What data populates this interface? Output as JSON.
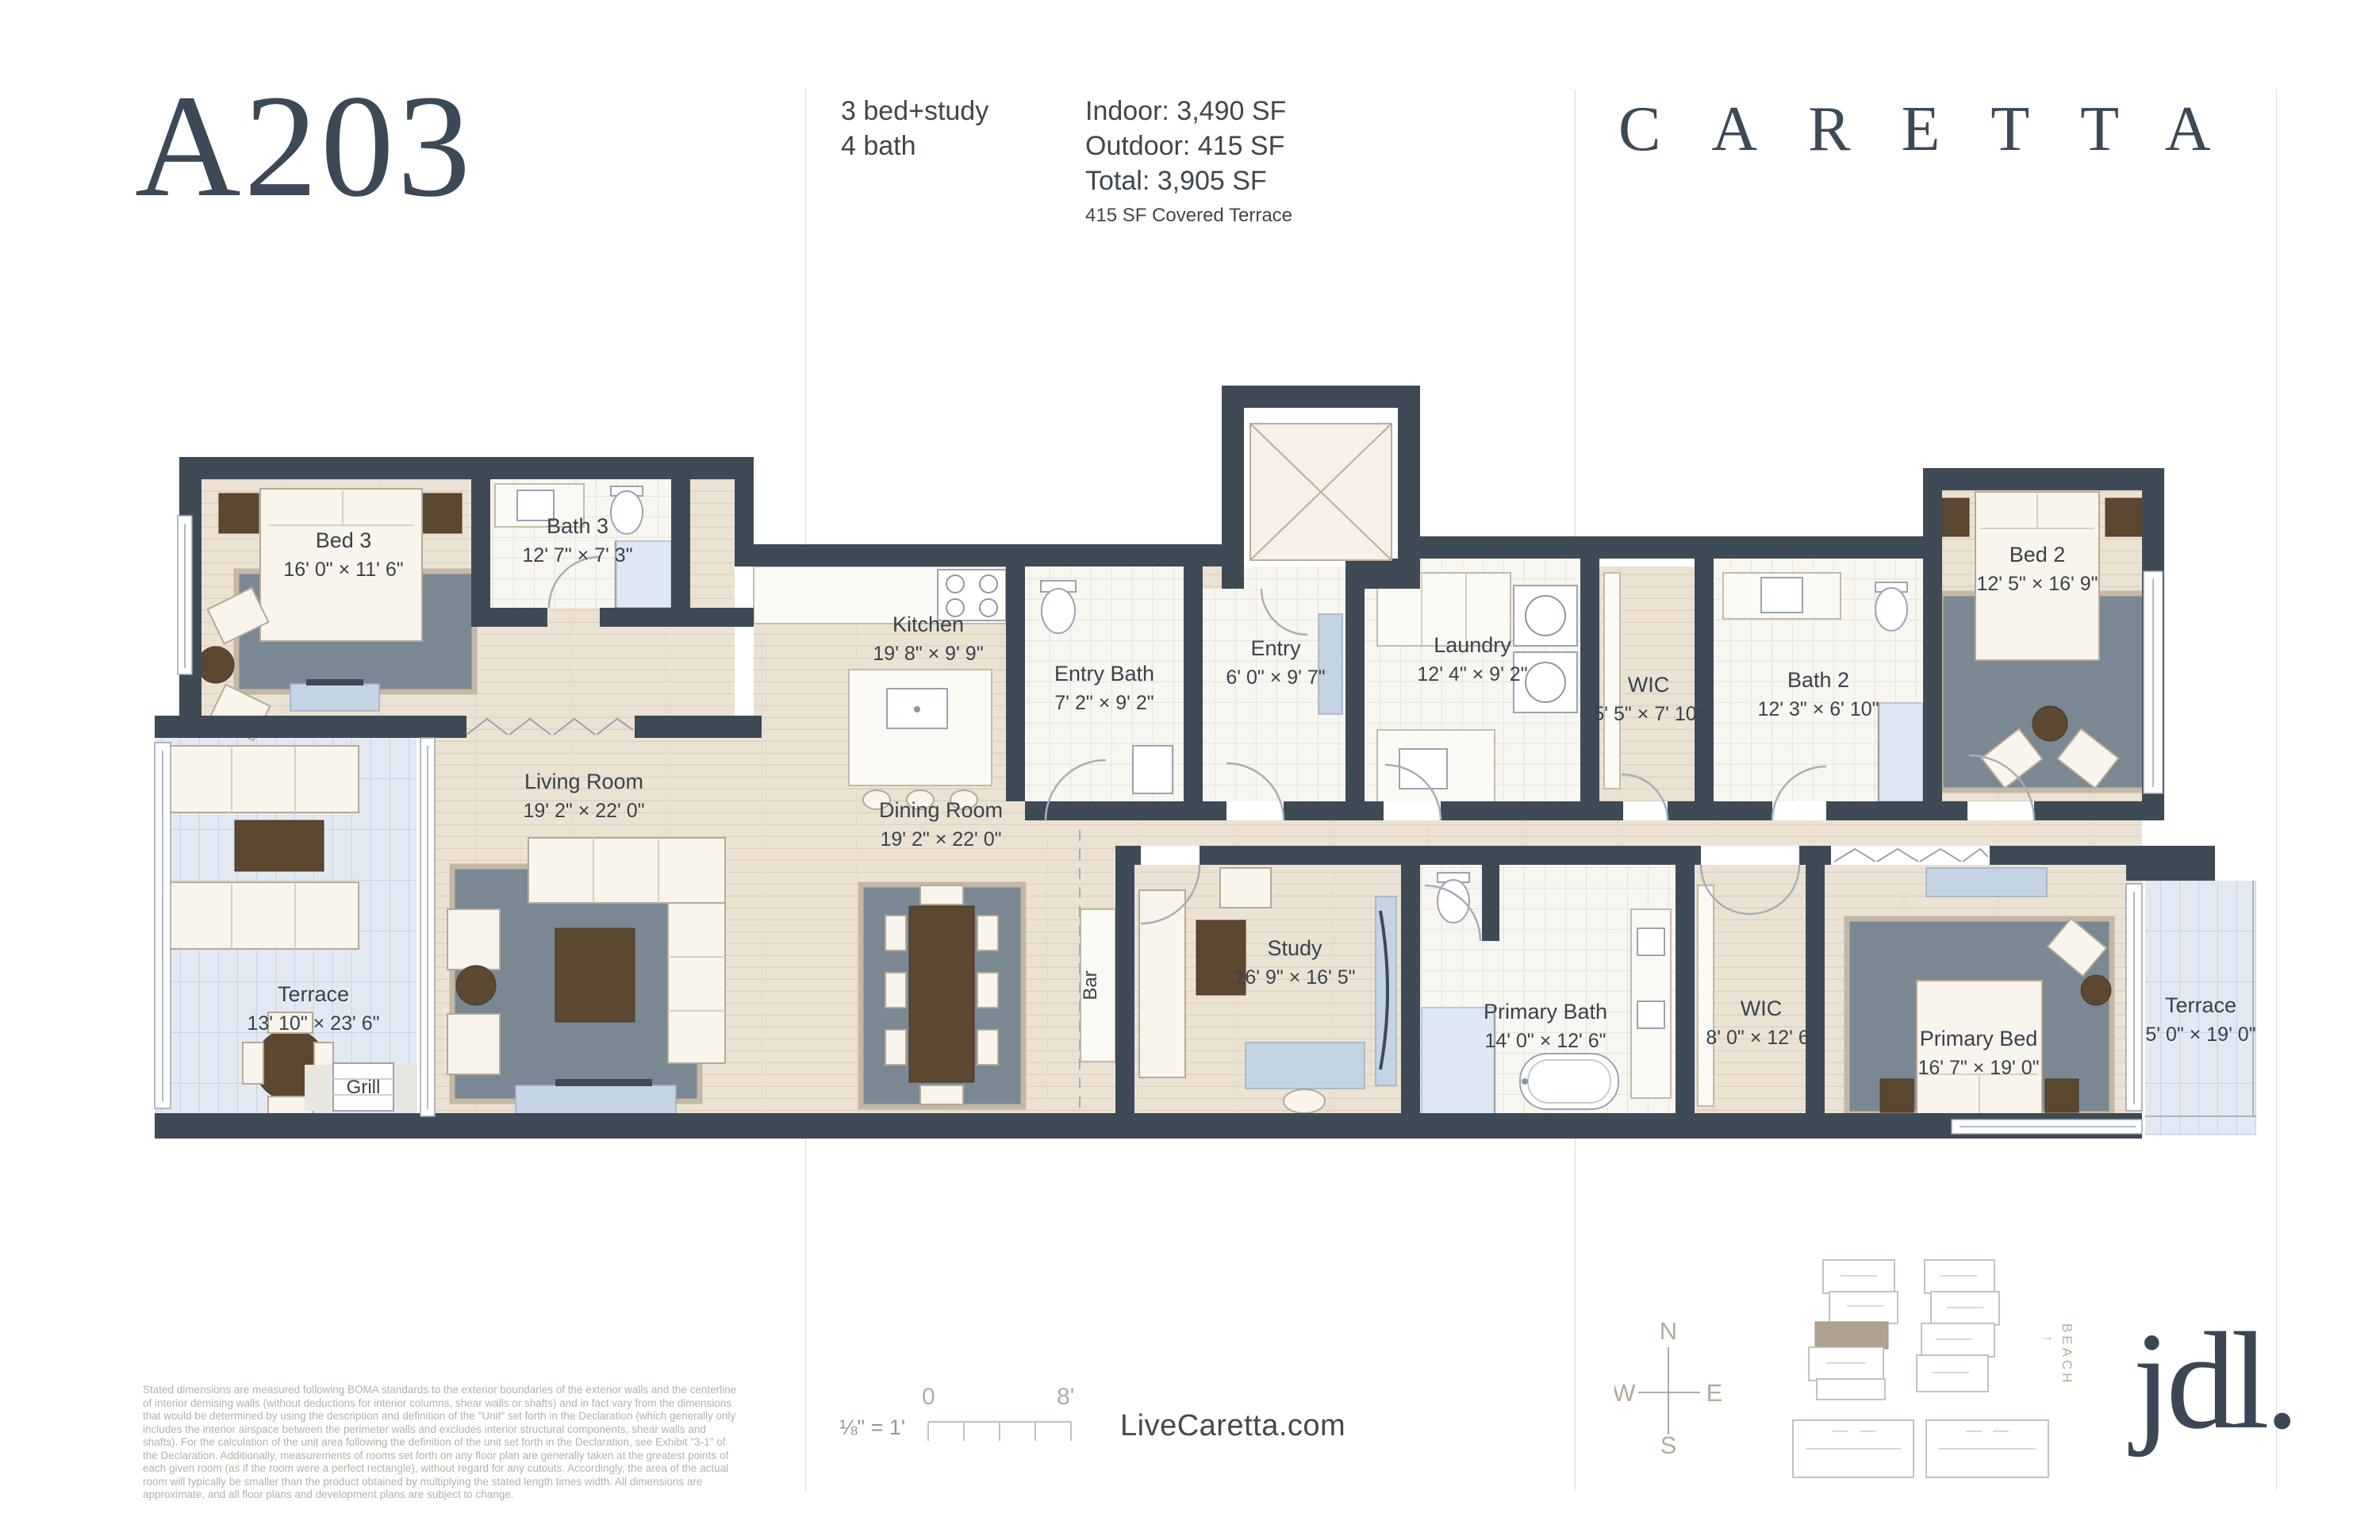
{
  "header": {
    "unit_id": "A203",
    "program": {
      "line1": "3 bed+study",
      "line2": "4 bath"
    },
    "areas": {
      "indoor": "Indoor: 3,490 SF",
      "outdoor": "Outdoor: 415 SF",
      "total": "Total: 3,905 SF",
      "note": "415 SF Covered Terrace"
    },
    "brand": "CARETTA"
  },
  "floorplan": {
    "rooms": [
      {
        "name": "Bed 3",
        "dims": "16' 0\" × 11' 6\""
      },
      {
        "name": "Bath 3",
        "dims": "12' 7\" × 7' 3\""
      },
      {
        "name": "Kitchen",
        "dims": "19' 8\" × 9' 9\""
      },
      {
        "name": "Entry Bath",
        "dims": "7' 2\" × 9' 2\""
      },
      {
        "name": "Entry",
        "dims": "6' 0\" × 9' 7\""
      },
      {
        "name": "Laundry",
        "dims": "12' 4\" × 9' 2\""
      },
      {
        "name": "WIC",
        "dims": "5' 5\" × 7' 10\""
      },
      {
        "name": "Bath 2",
        "dims": "12' 3\" × 6' 10\""
      },
      {
        "name": "Bed 2",
        "dims": "12' 5\" × 16' 9\""
      },
      {
        "name": "Living Room",
        "dims": "19' 2\" × 22' 0\""
      },
      {
        "name": "Dining Room",
        "dims": "19' 2\" × 22' 0\""
      },
      {
        "name": "Terrace",
        "dims": "13' 10\" × 23' 6\""
      },
      {
        "name": "Study",
        "dims": "16' 9\" × 16' 5\""
      },
      {
        "name": "Primary Bath",
        "dims": "14' 0\" × 12' 6\""
      },
      {
        "name": "WIC",
        "dims": "8' 0\" × 12' 6\""
      },
      {
        "name": "Primary Bed",
        "dims": "16' 7\" × 19' 0\""
      },
      {
        "name": "Terrace",
        "dims": "5' 0\" × 19' 0\""
      },
      {
        "name": "Grill",
        "dims": ""
      },
      {
        "name": "Bar",
        "dims": ""
      }
    ]
  },
  "footer": {
    "disclaimer": "Stated dimensions are measured following BOMA standards to the exterior boundaries of the exterior walls and the centerline of interior demising walls (without deductions for interior columns, shear walls or shafts) and in fact vary from the dimensions that would be determined by using the description and definition of the \"Unit\" set forth in the Declaration (which generally only includes the interior airspace between the perimeter walls and excludes interior structural components, shear walls and shafts). For the calculation of the unit area following the definition of the unit set forth in the Declaration, see Exhibit \"3-1\" of the Declaration. Additionally, measurements of rooms set forth on any floor plan are generally taken at the greatest points of each given room (as if the room were a perfect rectangle), without regard for any cutouts. Accordingly, the area of the actual room will typically be smaller than the product obtained by multiplying the stated length times width. All dimensions are approximate, and all floor plans and development plans are subject to change.",
    "scale": {
      "label": "⅛\" = 1'",
      "start": "0",
      "end": "8'"
    },
    "website": "LiveCaretta.com",
    "compass": {
      "n": "N",
      "s": "S",
      "e": "E",
      "w": "W"
    },
    "sitemap": {
      "beach": "BEACH"
    },
    "logo": "jdl."
  },
  "colors": {
    "ink": "#3c4957",
    "wall": "#3e4a55",
    "wood_floor": "#ebe2d4",
    "tile_floor": "#f8f6f1",
    "terrace_tile": "#e3e9f2",
    "rug": "#7a8894",
    "accent_brown": "#5c4731",
    "accent_blue": "#c4d4e4",
    "muted_text": "#b5b1a6",
    "site_highlight": "#b0a290"
  }
}
